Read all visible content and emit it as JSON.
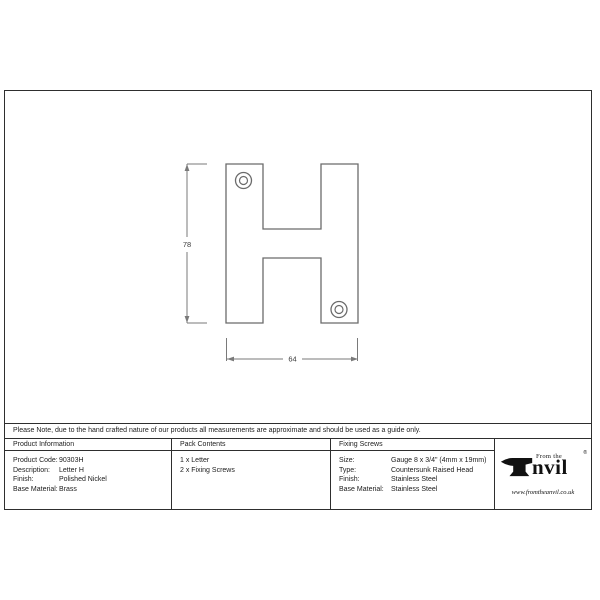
{
  "drawing": {
    "height_dimension": "78",
    "width_dimension": "64",
    "line_color": "#6b6b6b",
    "dim_line_color": "#7a7a7a",
    "dim_text_color": "#3c3c3c"
  },
  "note": "Please Note, due to the hand crafted nature of our products all measurements are approximate and should be used as a guide only.",
  "table": {
    "product_information": {
      "header": "Product Information",
      "rows": [
        [
          "Product Code:",
          "90303H"
        ],
        [
          "Description:",
          "Letter H"
        ],
        [
          "Finish:",
          "Polished Nickel"
        ],
        [
          "Base Material:",
          "Brass"
        ]
      ]
    },
    "pack_contents": {
      "header": "Pack Contents",
      "items": [
        "1 x Letter",
        "2 x Fixing Screws"
      ]
    },
    "fixing_screws": {
      "header": "Fixing Screws",
      "rows": [
        [
          "Size:",
          "Gauge 8 x 3/4\" (4mm x 19mm)"
        ],
        [
          "Type:",
          "Countersunk Raised Head"
        ],
        [
          "Finish:",
          "Stainless Steel"
        ],
        [
          "Base Material:",
          "Stainless Steel"
        ]
      ]
    }
  },
  "logo": {
    "from_the": "From the",
    "name_rest": "nvil",
    "registered": "®",
    "url": "www.fromtheanvil.co.uk",
    "color": "#111111"
  }
}
